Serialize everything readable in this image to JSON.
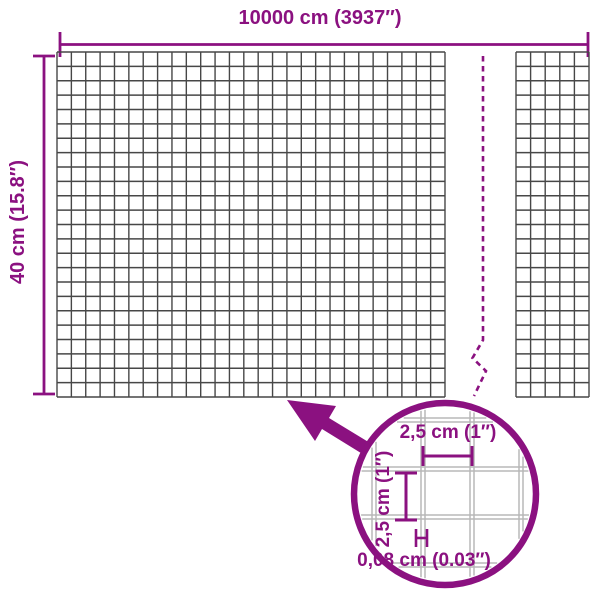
{
  "diagram": {
    "roll": {
      "width_label": "10000 cm (3937″)",
      "height_label": "40 cm (15.8″)"
    },
    "detail": {
      "mesh_width_label": "2,5 cm (1″)",
      "mesh_height_label": "2,5 cm (1″)",
      "wire_thickness_label": "0,08 cm (0.03″)"
    },
    "icons": {
      "zoom_arrow": "arrow-up-left",
      "detail_circle": "magnifier-circle"
    },
    "colors": {
      "accent": "#8b1180",
      "mesh_line": "#474747",
      "detail_wire": "#b8b8b8",
      "background": "#ffffff"
    }
  }
}
